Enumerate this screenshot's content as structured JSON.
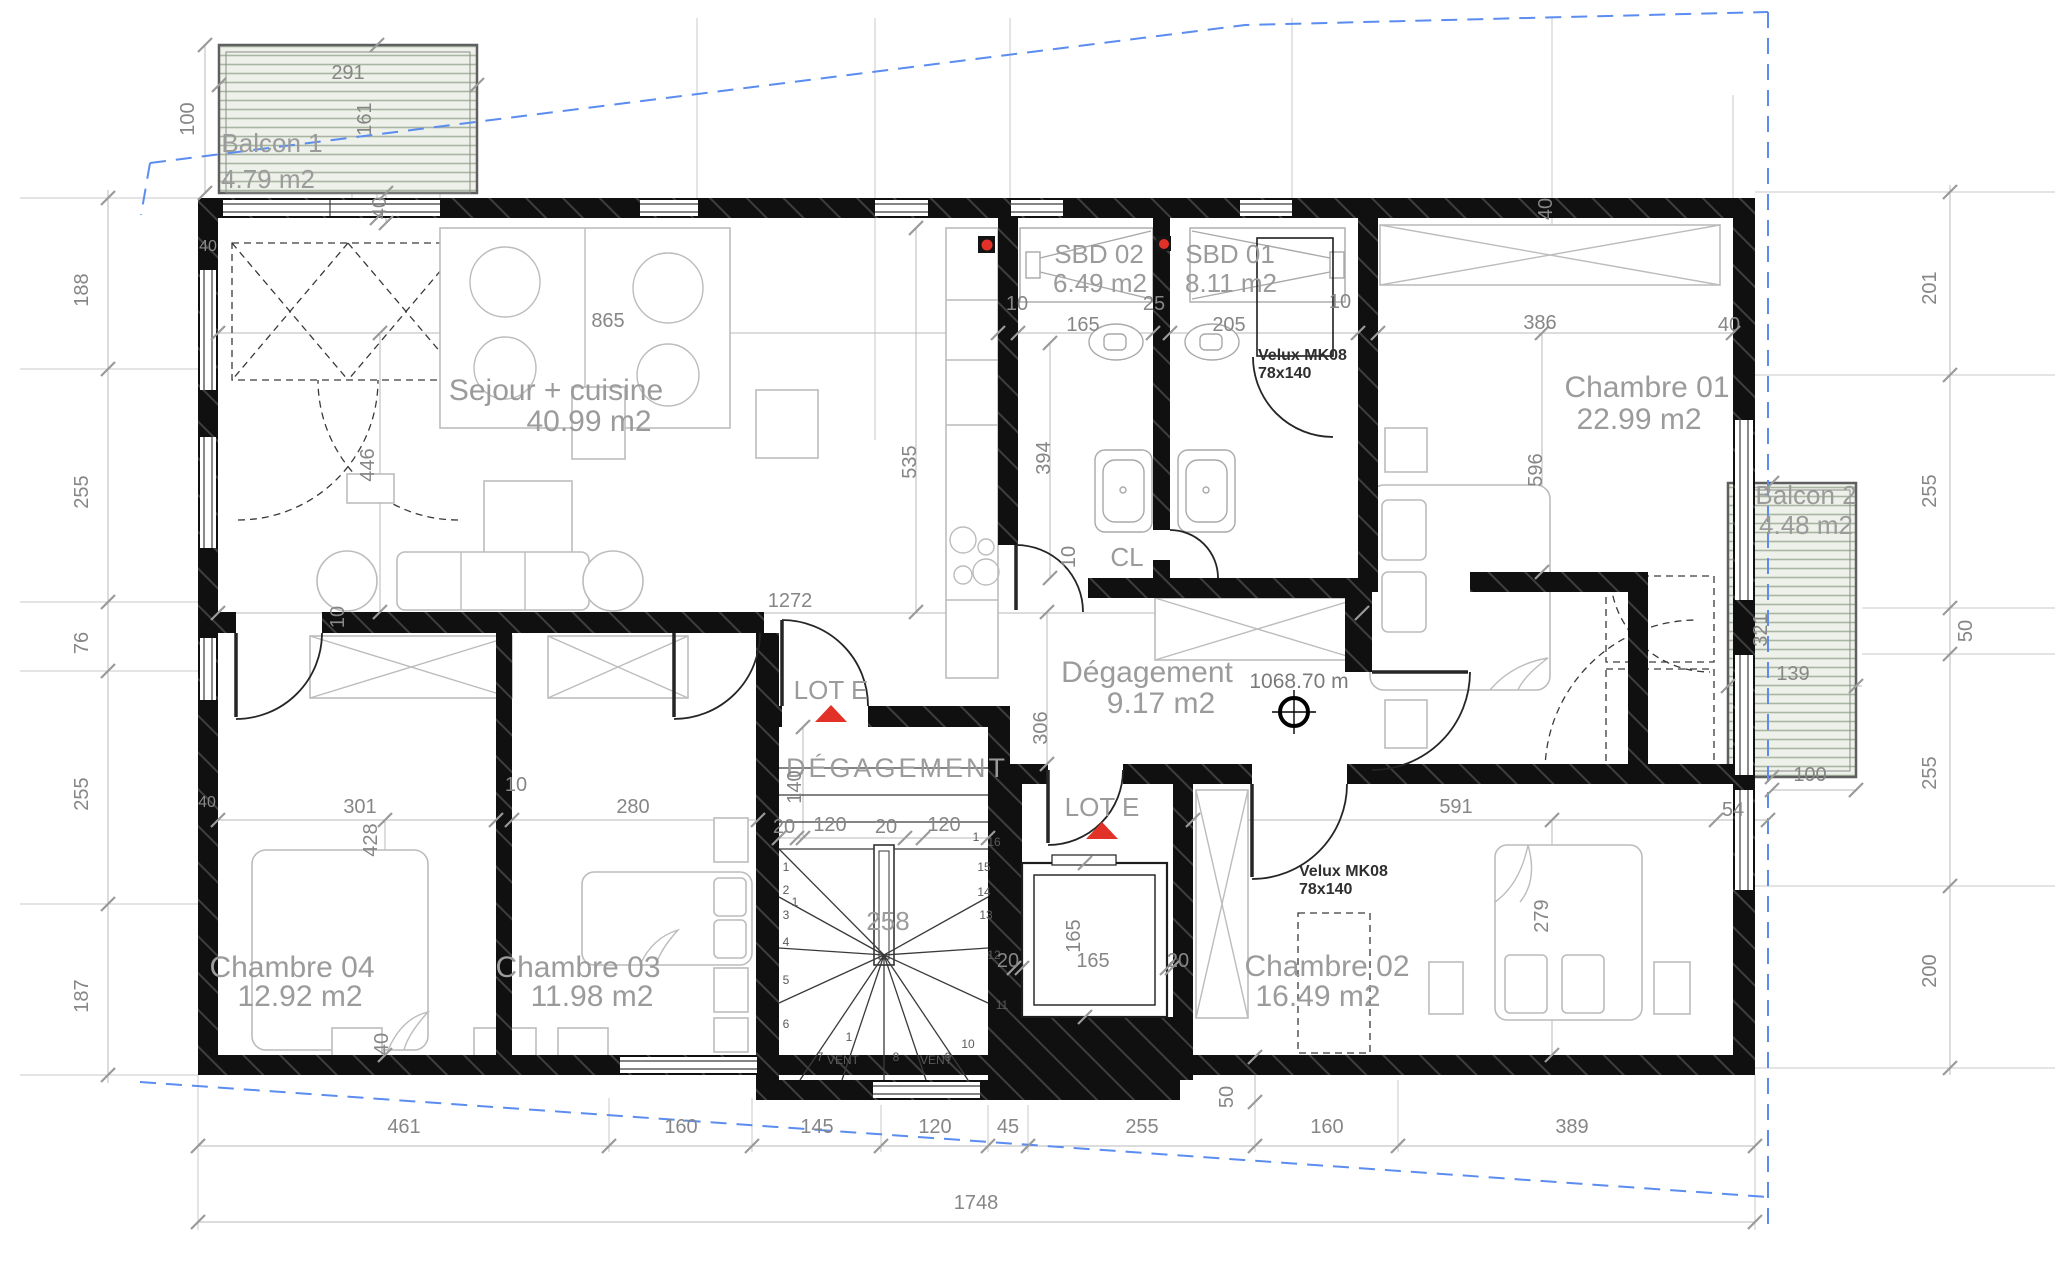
{
  "drawing": {
    "rooms": {
      "balcon1": {
        "name": "Balcon 1",
        "area": "4.79 m2"
      },
      "sejour": {
        "name": "Sejour + cuisine",
        "area": "40.99 m2"
      },
      "sbd02": {
        "name": "SBD 02",
        "area": "6.49 m2"
      },
      "sbd01": {
        "name": "SBD 01",
        "area": "8.11 m2"
      },
      "chambre01": {
        "name": "Chambre 01",
        "area": "22.99 m2"
      },
      "balcon2": {
        "name": "Balcon 2",
        "area": "4.48 m2"
      },
      "hall": {
        "name": "Dégagement",
        "area": "9.17 m2"
      },
      "stairwell": {
        "name": "DÉGAGEMENT"
      },
      "chambre04": {
        "name": "Chambre 04",
        "area": "12.92 m2"
      },
      "chambre03": {
        "name": "Chambre 03",
        "area": "11.98 m2"
      },
      "chambre02": {
        "name": "Chambre 02",
        "area": "16.49 m2"
      },
      "closet": {
        "name": "CL"
      }
    },
    "annotations": {
      "lot": "LOT E",
      "level": "1068.70 m",
      "velux_model": "Velux MK08",
      "velux_size": "78x140",
      "vent": "VENT"
    },
    "stairs": {
      "steps": [
        "1",
        "2",
        "3",
        "4",
        "5",
        "6",
        "7",
        "8",
        "9",
        "10",
        "11",
        "12",
        "13",
        "14",
        "15",
        "16"
      ],
      "mark": "1"
    },
    "dims": {
      "left": [
        "188",
        "255",
        "76",
        "255",
        "187"
      ],
      "right": [
        "201",
        "255",
        "50",
        "255",
        "200"
      ],
      "bottom": [
        "461",
        "160",
        "145",
        "120",
        "45",
        "255",
        "160",
        "389"
      ],
      "total": "1748",
      "balcon1_w": "291",
      "balcon1_d": "161",
      "balcon1_h": "100",
      "wall40": "40",
      "t10": "10",
      "t20": "20",
      "t25": "25",
      "t50": "50",
      "t54": "54",
      "sejour_w": "865",
      "sejour_h": "446",
      "sejour_h2": "535",
      "sejour_w2": "1272",
      "sbd02_w": "165",
      "sbd02_h": "394",
      "sbd01_w": "205",
      "ch01_w": "386",
      "ch01_h": "596",
      "balcon2_h": "321",
      "balcon2_d": "139",
      "balcon2_w": "100",
      "ch04_w": "301",
      "ch04_h": "428",
      "ch03_w": "280",
      "ch02_w": "591",
      "ch02_h": "279",
      "hall_h": "306",
      "stair_d": "140",
      "stair_s20": "20",
      "stair_s120": "120",
      "stair_w": "258",
      "lift_w": "165",
      "lift_h": "165"
    },
    "colors": {
      "wall": "#101010",
      "dim_text": "#868686",
      "room_text": "#9b9b9b",
      "property_line": "#5b8cf0",
      "marker_red": "#e23227",
      "deck_line": "#a8b5a0"
    }
  }
}
